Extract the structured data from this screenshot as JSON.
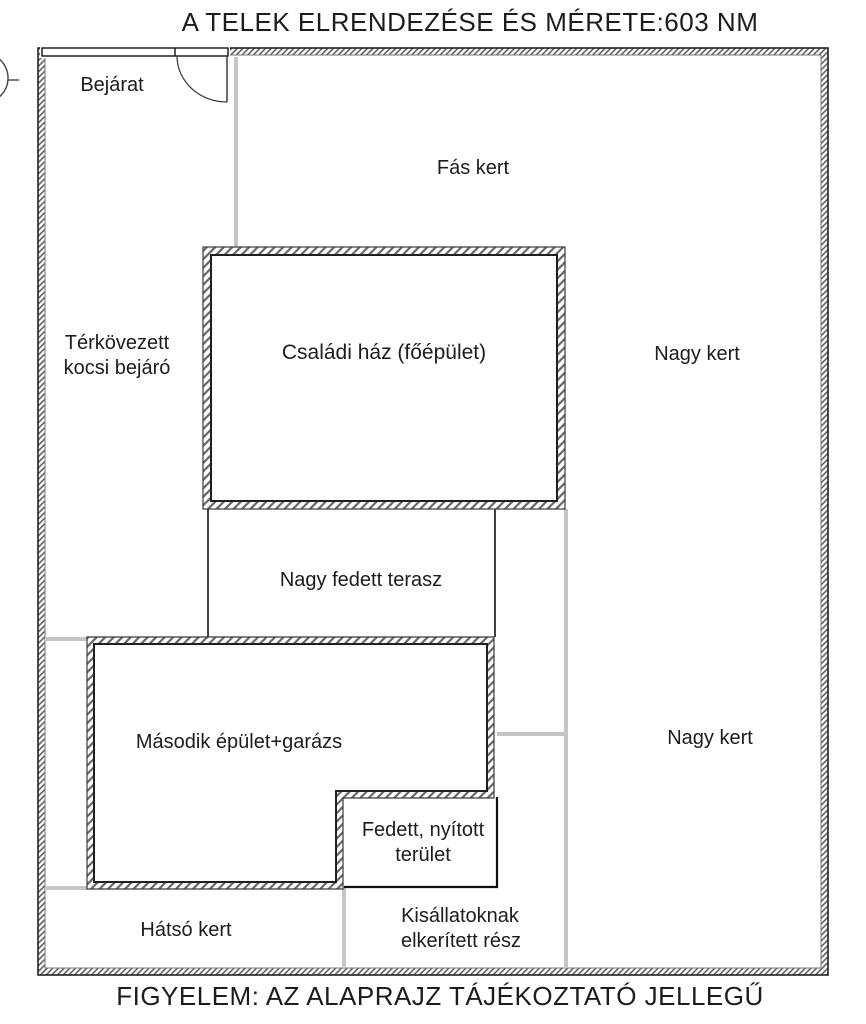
{
  "title": "A TELEK ELRENDEZÉSE ÉS MÉRETE:603 NM",
  "footer": "FIGYELEM: AZ ALAPRAJZ TÁJÉKOZTATÓ JELLEGŰ",
  "labels": {
    "entrance": "Bejárat",
    "wooded_garden": "Fás kert",
    "paved_driveway_line1": "Térkövezett",
    "paved_driveway_line2": "kocsi bejáró",
    "main_house": "Családi ház (főépület)",
    "big_garden_upper": "Nagy kert",
    "covered_terrace": "Nagy fedett terasz",
    "second_building": "Második épület+garázs",
    "big_garden_lower": "Nagy kert",
    "covered_open_area_line1": "Fedett, nyított",
    "covered_open_area_line2": "terület",
    "back_garden": "Hátsó kert",
    "pets_area_line1": "Kisállatoknak",
    "pets_area_line2": "elkerített rész"
  },
  "colors": {
    "text": "#1c1c1c",
    "wall_outline": "#2b2b2b",
    "hatch": "#666666",
    "divider_gray": "#c5c5c5",
    "background": "#ffffff"
  }
}
